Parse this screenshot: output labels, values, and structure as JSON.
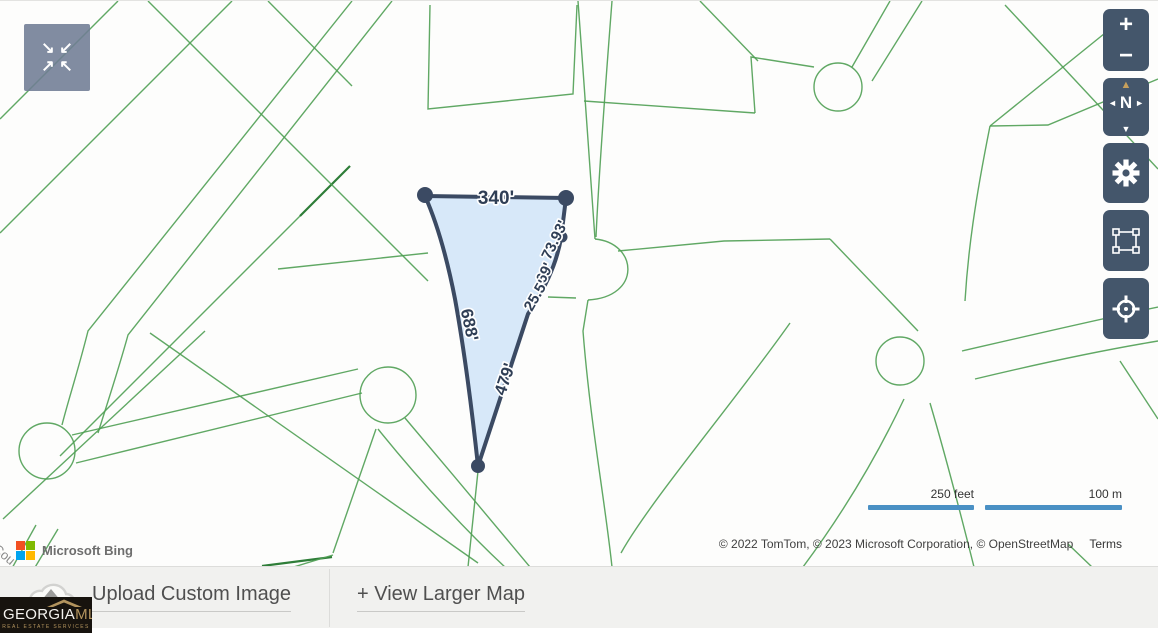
{
  "map": {
    "parcel": {
      "top_label": "340'",
      "right_labels": [
        "73.93'",
        "69'",
        "25.5'"
      ],
      "left_label": "688'",
      "bottom_label": "479'"
    },
    "street_label": "Cou",
    "scale_bar": {
      "imperial": "250 feet",
      "metric": "100 m"
    },
    "attribution": {
      "provider": "Microsoft Bing",
      "copyright": "© 2022 TomTom, © 2023 Microsoft Corporation, © OpenStreetMap",
      "terms": "Terms"
    },
    "controls": {
      "zoom_in": "+",
      "zoom_out": "−",
      "compass_north": "N"
    }
  },
  "icons": {
    "collapse_tl": "↘",
    "collapse_tr": "↙",
    "collapse_bl": "↗",
    "collapse_br": "↖",
    "compass_up": "▲",
    "compass_down": "▼",
    "compass_left": "◄",
    "compass_right": "►"
  },
  "footer": {
    "upload_label": "Upload Custom Image",
    "view_larger_label": "+ View Larger Map"
  },
  "brand": {
    "primary": "GEORGIA",
    "secondary": "MLS",
    "tagline": "REAL ESTATE SERVICES"
  },
  "colors": {
    "control_bg": "#44566b",
    "parcel_outline": "#3b4a63",
    "parcel_fill": "#cde2f8",
    "map_line_green": "#4f9e53",
    "scale_bar_blue": "#4a90c4",
    "compass_arrow_tan": "#c7a05c",
    "brand_gold": "#b3945e",
    "ms_red": "#f25022",
    "ms_green": "#7fba00",
    "ms_blue": "#00a4ef",
    "ms_yellow": "#ffb900"
  }
}
